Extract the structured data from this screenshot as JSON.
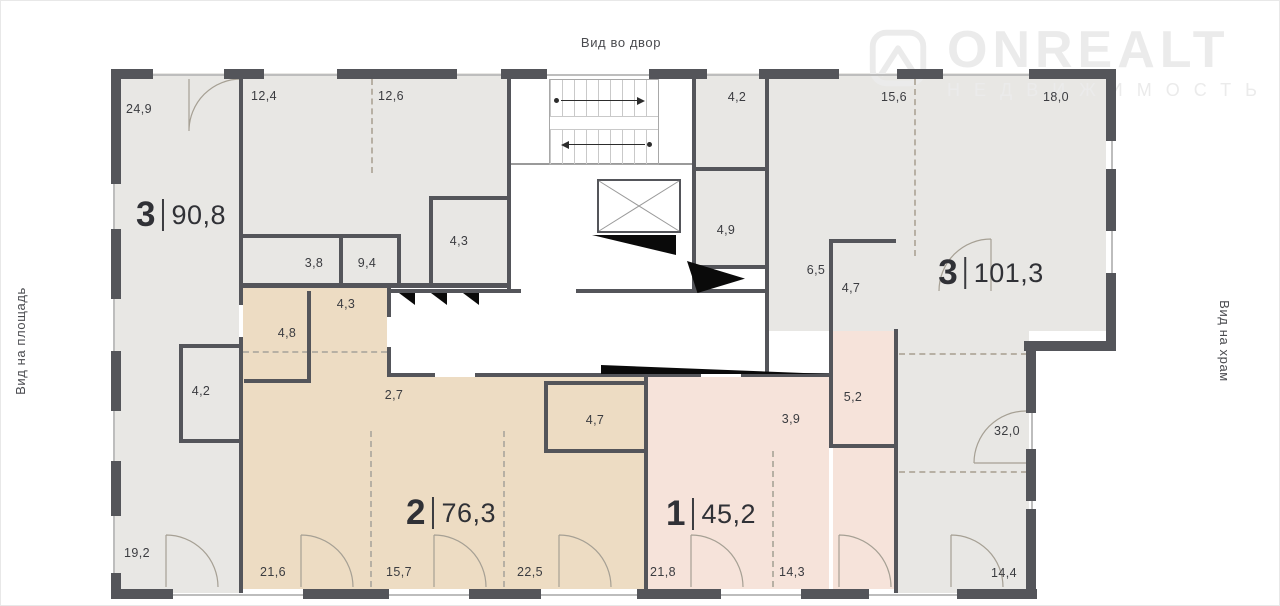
{
  "labels": {
    "top_view": "Вид во двор",
    "left_view": "Вид на площадь",
    "right_view": "Вид на храм"
  },
  "logo": {
    "name": "ONREALT",
    "subtitle": "НЕДВИЖИМОСТЬ"
  },
  "apartments": [
    {
      "num": "3",
      "area": "90,8"
    },
    {
      "num": "2",
      "area": "76,3"
    },
    {
      "num": "1",
      "area": "45,2"
    },
    {
      "num": "3",
      "area": "101,3"
    }
  ],
  "rooms": [
    "24,9",
    "12,4",
    "12,6",
    "3,8",
    "9,4",
    "4,3",
    "4,2",
    "19,2",
    "4,3",
    "4,8",
    "2,7",
    "4,7",
    "21,6",
    "15,7",
    "22,5",
    "21,8",
    "14,3",
    "3,9",
    "5,2",
    "4,2",
    "4,9",
    "6,5",
    "4,7",
    "15,6",
    "18,0",
    "32,0",
    "14,4"
  ],
  "colors": {
    "wall": "#54555a",
    "apartment_gray": "#e8e7e4",
    "apartment_beige": "#eddcc3",
    "apartment_pink": "#f6e3da",
    "watermark": "#ebebeb"
  }
}
